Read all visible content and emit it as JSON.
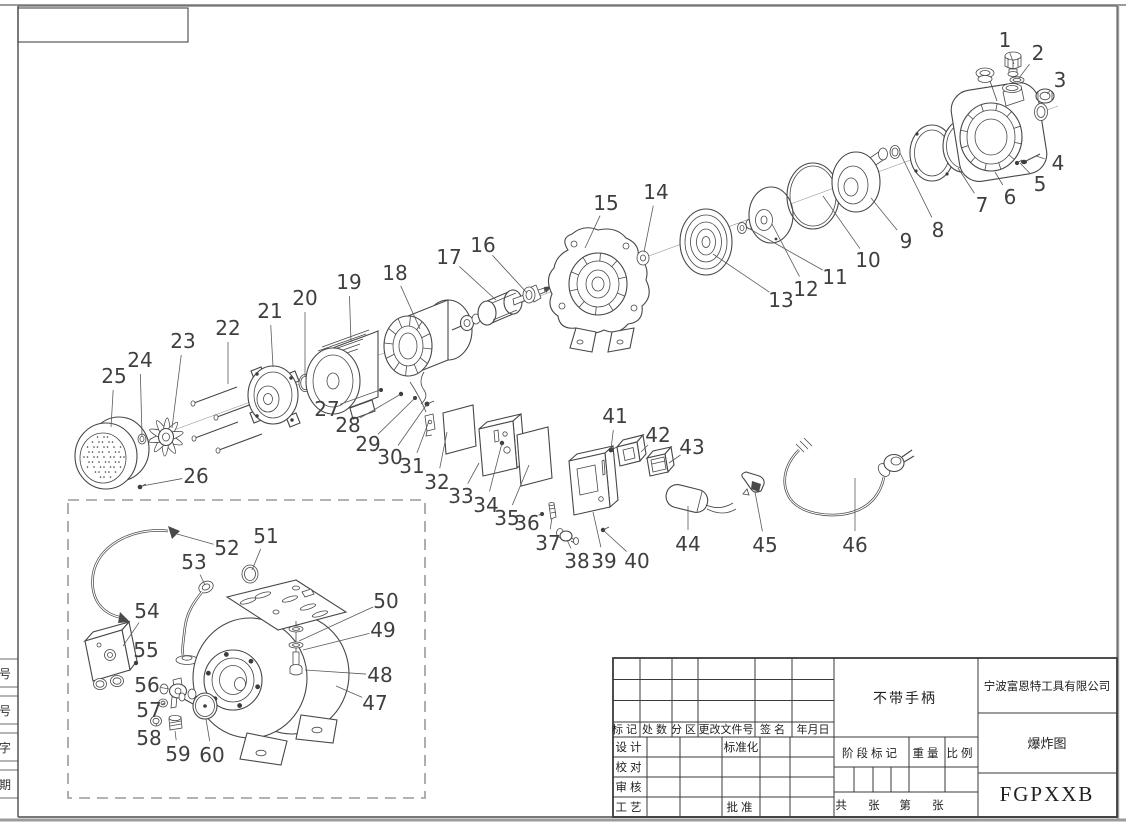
{
  "title_block": {
    "company": "宁波富恩特工具有限公司",
    "note": "不带手柄",
    "drawing_type": "爆炸图",
    "model": "FGPXXB",
    "rev_headers": [
      "标记",
      "处数",
      "分区",
      "更改文件号",
      "签名",
      "年月日"
    ],
    "roles": [
      "设计",
      "校对",
      "审核",
      "工艺"
    ],
    "standardization": "标准化",
    "approval": "批准",
    "stage": "阶段标记",
    "weight": "重量",
    "scale": "比例",
    "sheets_total": "共 张",
    "sheet_number": "第 张"
  },
  "margin_labels": [
    "号",
    "号",
    "字",
    "期"
  ],
  "parts": [
    {
      "n": 1,
      "x": 1005,
      "y": 40,
      "tx": 1014,
      "ty": 64
    },
    {
      "n": 2,
      "x": 1038,
      "y": 53,
      "tx": 1019,
      "ty": 78
    },
    {
      "n": 3,
      "x": 1060,
      "y": 80,
      "tx": 1047,
      "ty": 94
    },
    {
      "n": 4,
      "x": 1058,
      "y": 163,
      "tx": 1036,
      "ty": 156
    },
    {
      "n": 5,
      "x": 1040,
      "y": 184,
      "tx": 1020,
      "ty": 163
    },
    {
      "n": 6,
      "x": 1010,
      "y": 197,
      "tx": 995,
      "ty": 172
    },
    {
      "n": 7,
      "x": 982,
      "y": 205,
      "tx": 958,
      "ty": 168
    },
    {
      "n": 8,
      "x": 938,
      "y": 230,
      "tx": 900,
      "ty": 153
    },
    {
      "n": 9,
      "x": 906,
      "y": 241,
      "tx": 871,
      "ty": 198
    },
    {
      "n": 10,
      "x": 868,
      "y": 260,
      "tx": 823,
      "ty": 196
    },
    {
      "n": 11,
      "x": 835,
      "y": 277,
      "tx": 748,
      "ty": 228
    },
    {
      "n": 12,
      "x": 806,
      "y": 289,
      "tx": 772,
      "ty": 224
    },
    {
      "n": 13,
      "x": 781,
      "y": 300,
      "tx": 713,
      "ty": 254
    },
    {
      "n": 14,
      "x": 656,
      "y": 192,
      "tx": 644,
      "ty": 252
    },
    {
      "n": 15,
      "x": 606,
      "y": 203,
      "tx": 585,
      "ty": 248
    },
    {
      "n": 16,
      "x": 483,
      "y": 245,
      "tx": 527,
      "ty": 293
    },
    {
      "n": 17,
      "x": 449,
      "y": 257,
      "tx": 496,
      "ty": 300
    },
    {
      "n": 18,
      "x": 395,
      "y": 273,
      "tx": 420,
      "ty": 329
    },
    {
      "n": 19,
      "x": 349,
      "y": 282,
      "tx": 351,
      "ty": 342
    },
    {
      "n": 20,
      "x": 305,
      "y": 298,
      "tx": 305,
      "ty": 376
    },
    {
      "n": 21,
      "x": 270,
      "y": 311,
      "tx": 273,
      "ty": 367
    },
    {
      "n": 22,
      "x": 228,
      "y": 328,
      "tx": 228,
      "ty": 384
    },
    {
      "n": 23,
      "x": 183,
      "y": 341,
      "tx": 172,
      "ty": 428
    },
    {
      "n": 24,
      "x": 140,
      "y": 360,
      "tx": 142,
      "ty": 436
    },
    {
      "n": 25,
      "x": 114,
      "y": 376,
      "tx": 111,
      "ty": 427
    },
    {
      "n": 26,
      "x": 196,
      "y": 476,
      "tx": 142,
      "ty": 486
    },
    {
      "n": 27,
      "x": 327,
      "y": 409,
      "tx": 380,
      "ty": 390
    },
    {
      "n": 28,
      "x": 348,
      "y": 425,
      "tx": 401,
      "ty": 394
    },
    {
      "n": 29,
      "x": 368,
      "y": 444,
      "tx": 415,
      "ty": 398
    },
    {
      "n": 30,
      "x": 390,
      "y": 457,
      "tx": 427,
      "ty": 404
    },
    {
      "n": 31,
      "x": 412,
      "y": 466,
      "tx": 429,
      "ty": 421
    },
    {
      "n": 32,
      "x": 437,
      "y": 482,
      "tx": 447,
      "ty": 432
    },
    {
      "n": 33,
      "x": 461,
      "y": 496,
      "tx": 479,
      "ty": 463
    },
    {
      "n": 34,
      "x": 486,
      "y": 505,
      "tx": 502,
      "ty": 443
    },
    {
      "n": 35,
      "x": 507,
      "y": 518,
      "tx": 529,
      "ty": 465
    },
    {
      "n": 36,
      "x": 527,
      "y": 523,
      "tx": 542,
      "ty": 513
    },
    {
      "n": 37,
      "x": 548,
      "y": 543,
      "tx": 552,
      "ty": 518
    },
    {
      "n": 38,
      "x": 577,
      "y": 561,
      "tx": 567,
      "ty": 540
    },
    {
      "n": 39,
      "x": 604,
      "y": 561,
      "tx": 593,
      "ty": 512
    },
    {
      "n": 40,
      "x": 637,
      "y": 561,
      "tx": 603,
      "ty": 530
    },
    {
      "n": 41,
      "x": 615,
      "y": 416,
      "tx": 611,
      "ty": 449
    },
    {
      "n": 42,
      "x": 658,
      "y": 435,
      "tx": 641,
      "ty": 452
    },
    {
      "n": 43,
      "x": 692,
      "y": 447,
      "tx": 669,
      "ty": 463
    },
    {
      "n": 44,
      "x": 688,
      "y": 544,
      "tx": 688,
      "ty": 506
    },
    {
      "n": 45,
      "x": 765,
      "y": 545,
      "tx": 755,
      "ty": 492
    },
    {
      "n": 46,
      "x": 855,
      "y": 545,
      "tx": 855,
      "ty": 478
    },
    {
      "n": 47,
      "x": 375,
      "y": 703,
      "tx": 336,
      "ty": 686
    },
    {
      "n": 48,
      "x": 380,
      "y": 675,
      "tx": 305,
      "ty": 670
    },
    {
      "n": 49,
      "x": 383,
      "y": 630,
      "tx": 303,
      "ty": 650
    },
    {
      "n": 50,
      "x": 386,
      "y": 601,
      "tx": 299,
      "ty": 641
    },
    {
      "n": 51,
      "x": 266,
      "y": 536,
      "tx": 252,
      "ty": 570
    },
    {
      "n": 52,
      "x": 227,
      "y": 548,
      "tx": 177,
      "ty": 534
    },
    {
      "n": 53,
      "x": 194,
      "y": 562,
      "tx": 205,
      "ty": 585
    },
    {
      "n": 54,
      "x": 147,
      "y": 611,
      "tx": 123,
      "ty": 646
    },
    {
      "n": 55,
      "x": 146,
      "y": 650,
      "tx": 137,
      "ty": 662
    },
    {
      "n": 56,
      "x": 147,
      "y": 685,
      "tx": 169,
      "ty": 689
    },
    {
      "n": 57,
      "x": 149,
      "y": 710,
      "tx": 165,
      "ty": 703
    },
    {
      "n": 58,
      "x": 149,
      "y": 738,
      "tx": 157,
      "ty": 724
    },
    {
      "n": 59,
      "x": 178,
      "y": 754,
      "tx": 175,
      "ty": 731
    },
    {
      "n": 60,
      "x": 212,
      "y": 755,
      "tx": 206,
      "ty": 719
    }
  ]
}
